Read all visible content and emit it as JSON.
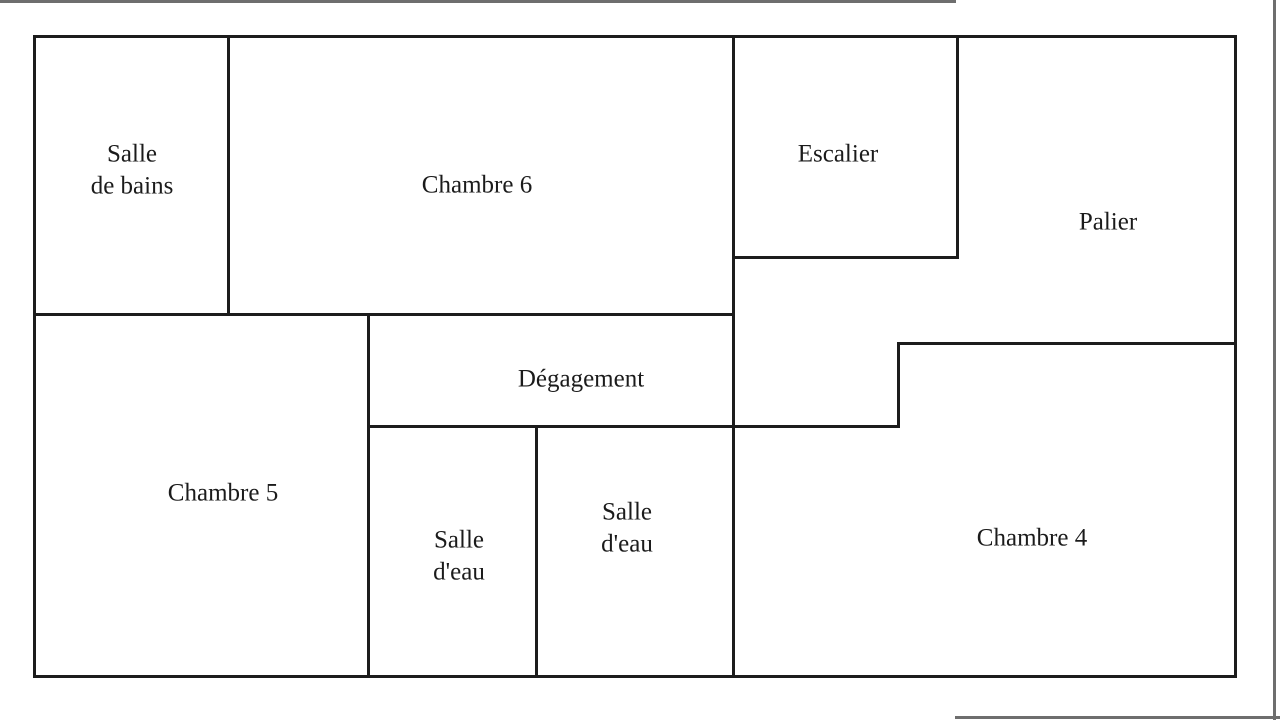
{
  "figure": {
    "type": "floor-plan",
    "language": "fr"
  },
  "colors": {
    "background": "#ffffff",
    "wall": "#1c1c1c",
    "text": "#1b1b1b",
    "page_artifact": "#6e6e6e"
  },
  "rooms": {
    "salle_de_bains": {
      "line1": "Salle",
      "line2": "de bains"
    },
    "chambre_6": {
      "label": "Chambre 6"
    },
    "escalier": {
      "label": "Escalier"
    },
    "palier": {
      "label": "Palier"
    },
    "chambre_5": {
      "label": "Chambre 5"
    },
    "degagement": {
      "label": "Dégagement"
    },
    "salle_eau_ouest": {
      "line1": "Salle",
      "line2": "d'eau"
    },
    "salle_eau_est": {
      "line1": "Salle",
      "line2": "d'eau"
    },
    "chambre_4": {
      "label": "Chambre 4"
    }
  }
}
